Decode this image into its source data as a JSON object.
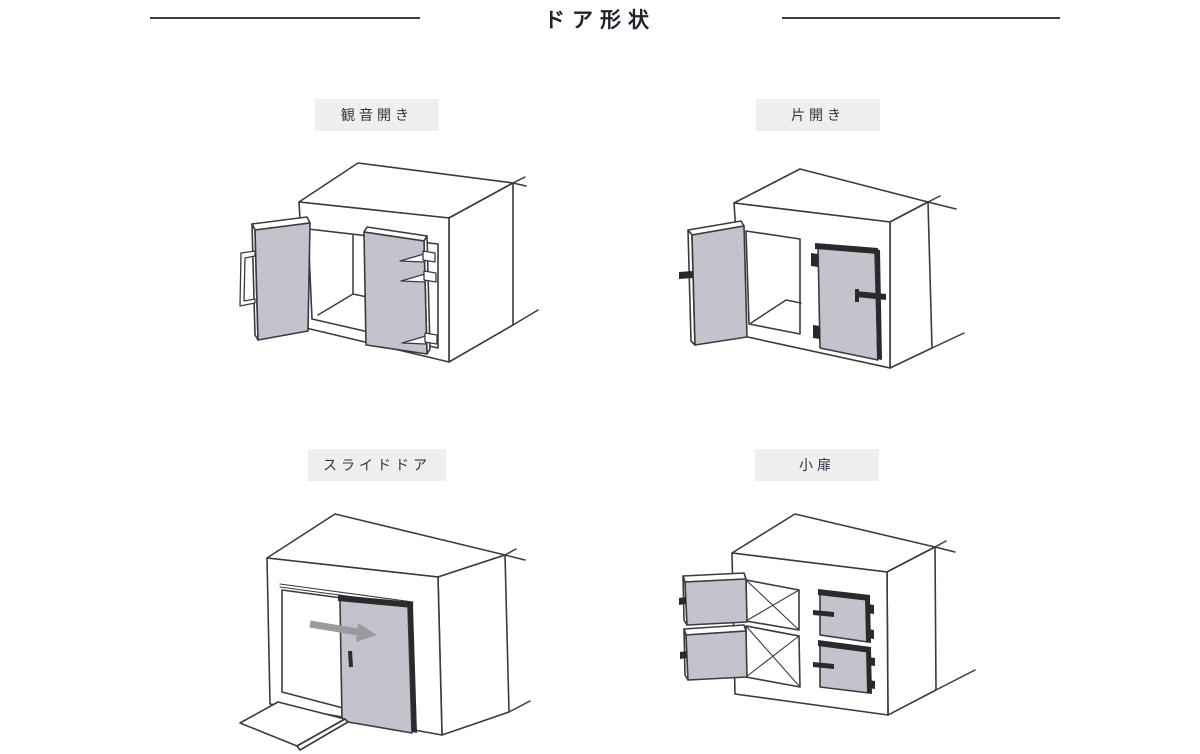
{
  "page": {
    "title": "ドア形状",
    "background": "#ffffff"
  },
  "sections": [
    {
      "id": "double-door",
      "label": "観音開き"
    },
    {
      "id": "single-door",
      "label": "片開き"
    },
    {
      "id": "sliding-door",
      "label": "スライドドア"
    },
    {
      "id": "small-door",
      "label": "小扉"
    }
  ],
  "colors": {
    "line": "#3b3b3f",
    "door": "#c3c2cd",
    "accent": "#2b292c",
    "arrow": "#9b9b9b",
    "label-bg": "#efefef",
    "label-fg": "#2d3442",
    "title-fg": "#1f232e",
    "rule": "#3c3e46"
  }
}
